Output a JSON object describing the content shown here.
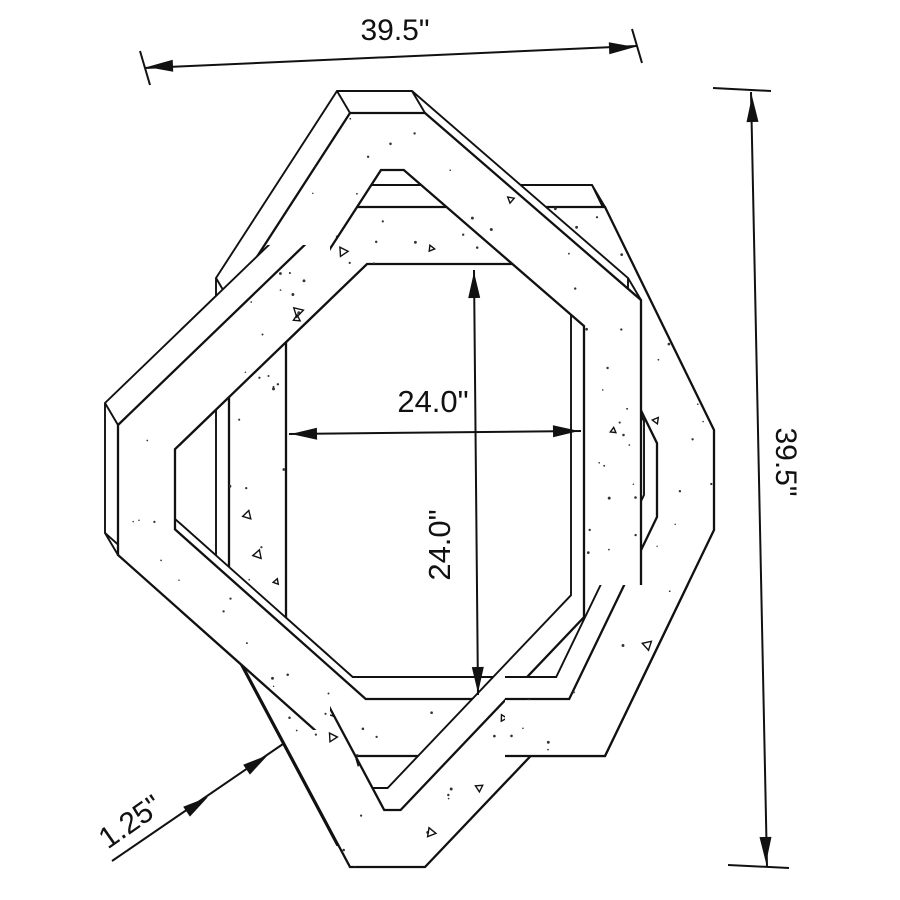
{
  "drawing": {
    "title": "Interlocking octagonal frame dimension drawing"
  },
  "dims": {
    "overall_width": "39.5\"",
    "overall_height": "39.5\"",
    "opening_width": "24.0\"",
    "opening_height": "24.0\"",
    "thickness": "1.25\""
  },
  "colors": {
    "line": "#111111",
    "background": "#ffffff"
  }
}
